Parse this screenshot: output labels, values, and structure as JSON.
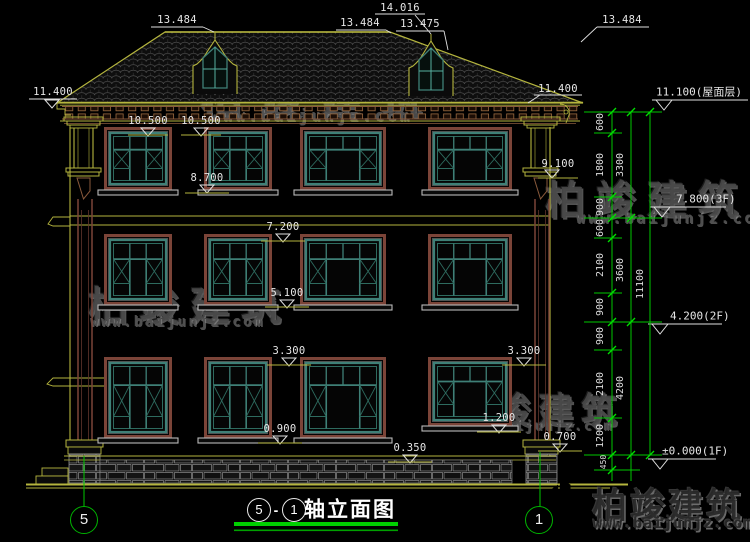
{
  "watermark": {
    "brand": "柏竣建筑",
    "site": "www.baijunjz.com"
  },
  "title": {
    "axis_from": "5",
    "sep": "-",
    "axis_to": "1",
    "text": "轴立面图"
  },
  "axis_bubbles": {
    "left": "5",
    "right": "1"
  },
  "dims": {
    "top": [
      {
        "text": "13.484"
      },
      {
        "text": "13.484"
      },
      {
        "text": "14.016"
      },
      {
        "text": "13.475"
      },
      {
        "text": "13.484"
      },
      {
        "text": "11.400"
      },
      {
        "text": "11.400"
      }
    ],
    "face": [
      {
        "text": "10.500"
      },
      {
        "text": "10.500"
      },
      {
        "text": "9.100"
      },
      {
        "text": "8.700"
      },
      {
        "text": "7.200"
      },
      {
        "text": "5.100"
      },
      {
        "text": "3.300"
      },
      {
        "text": "3.300"
      },
      {
        "text": "1.200"
      },
      {
        "text": "0.900"
      },
      {
        "text": "0.700"
      },
      {
        "text": "0.350"
      }
    ],
    "levels": [
      {
        "text": "11.100(屋面层)"
      },
      {
        "text": "7.800(3F)"
      },
      {
        "text": "4.200(2F)"
      },
      {
        "text": "±0.000(1F)"
      }
    ],
    "chain_segments": [
      "600",
      "1800",
      "900",
      "600",
      "2100",
      "900",
      "900",
      "2100",
      "1200"
    ],
    "chain_groups": [
      "3300",
      "3600",
      "4200"
    ],
    "chain_total": "11100",
    "chain_below": "450"
  },
  "colors": {
    "dim_green": "#00c800",
    "line_yellow": "#b5b53e",
    "frame_brown": "#7b4438",
    "sash_teal": "#3f8077",
    "text_white": "#e6e6e6"
  }
}
